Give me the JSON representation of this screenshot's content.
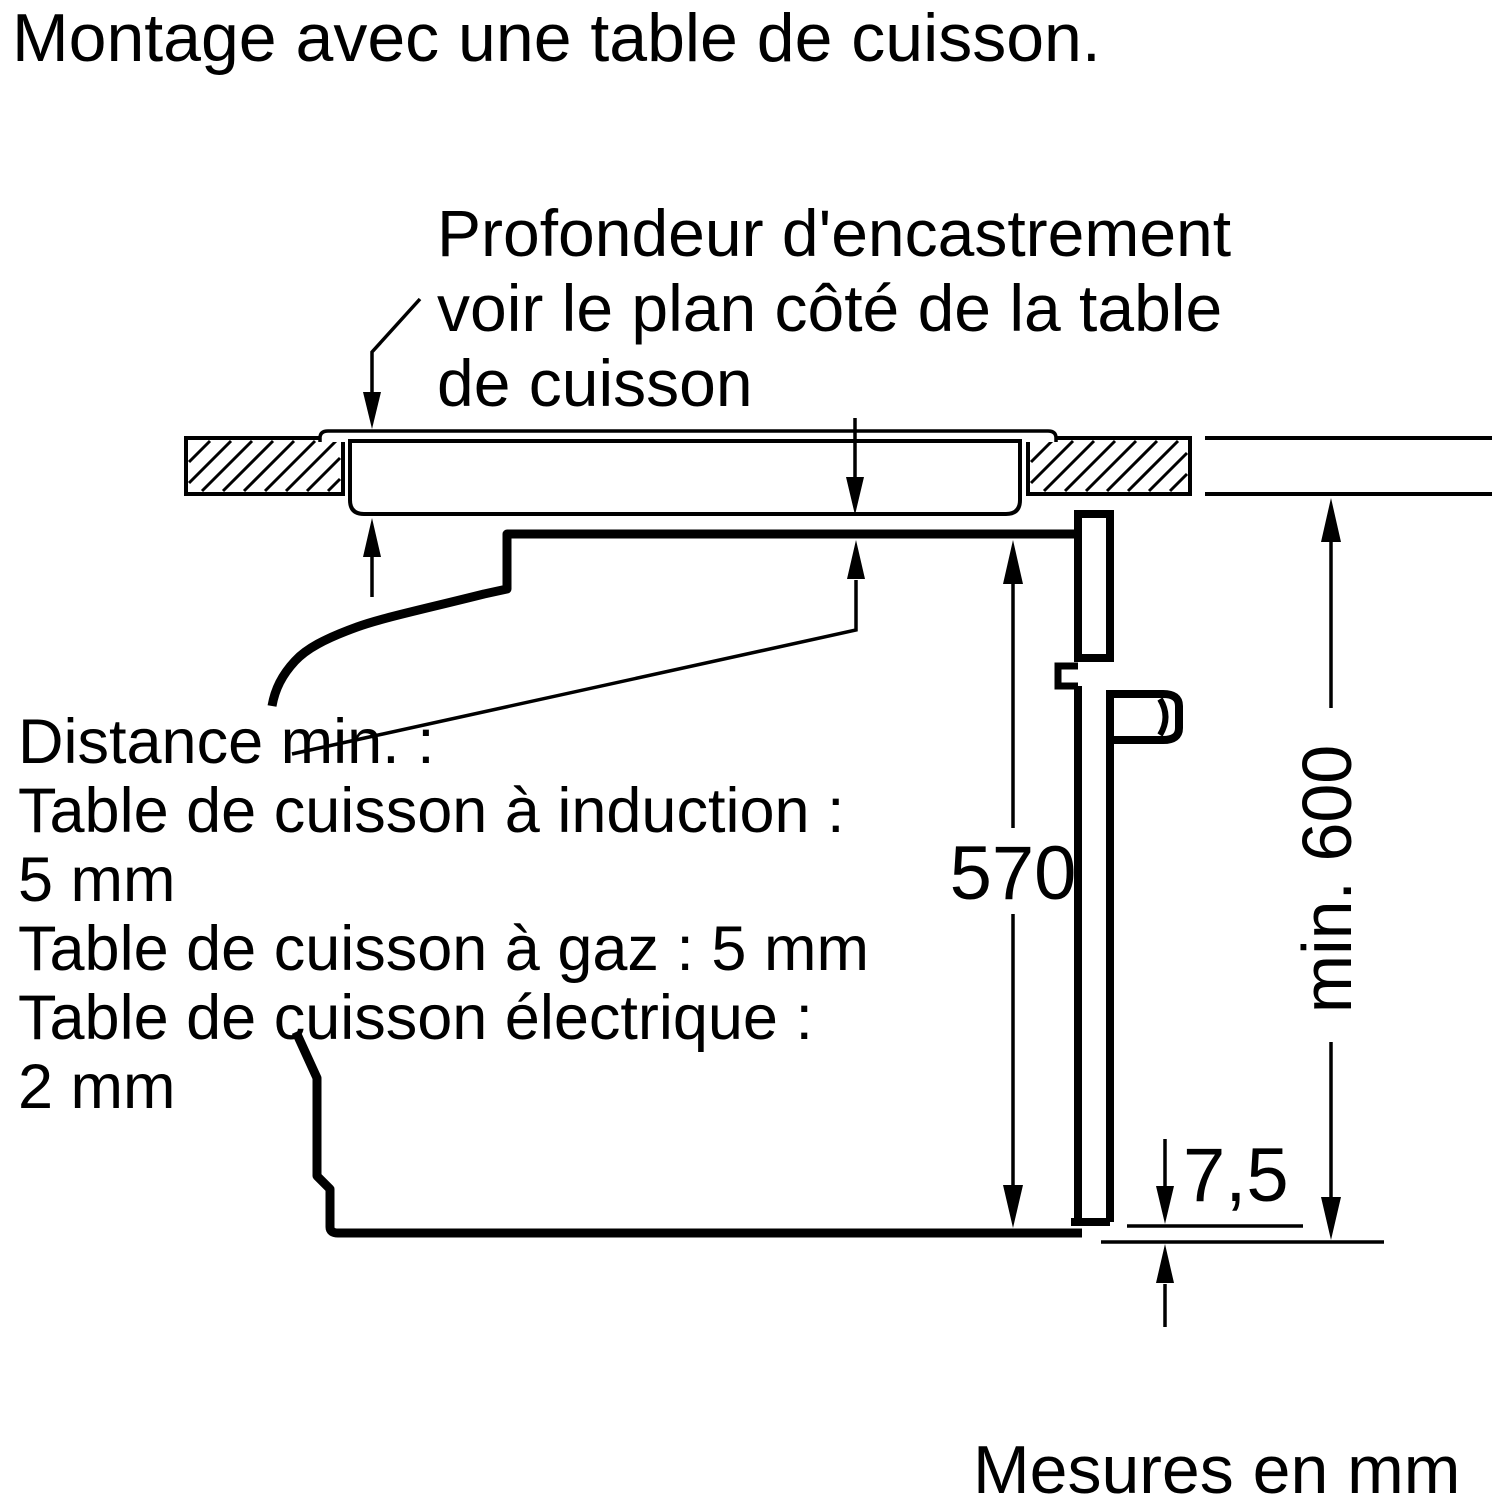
{
  "page": {
    "title": "Montage avec une table de cuisson.",
    "footer": "Mesures en mm"
  },
  "annotation": {
    "line1": "Profondeur d'encastrement",
    "line2": "voir le plan côté de la table",
    "line3": "de cuisson"
  },
  "notes": {
    "line1": "Distance min. :",
    "line2": "Table de cuisson à induction :",
    "line3": "5 mm",
    "line4": "Table de cuisson à gaz : 5 mm",
    "line5": "Table de cuisson électrique :",
    "line6": "2 mm"
  },
  "dimensions": {
    "oven_height_mm": "570",
    "niche_min_height_mm": "min. 600",
    "door_bottom_gap_mm": "7,5"
  },
  "colors": {
    "ink": "#000000",
    "paper": "#ffffff"
  }
}
